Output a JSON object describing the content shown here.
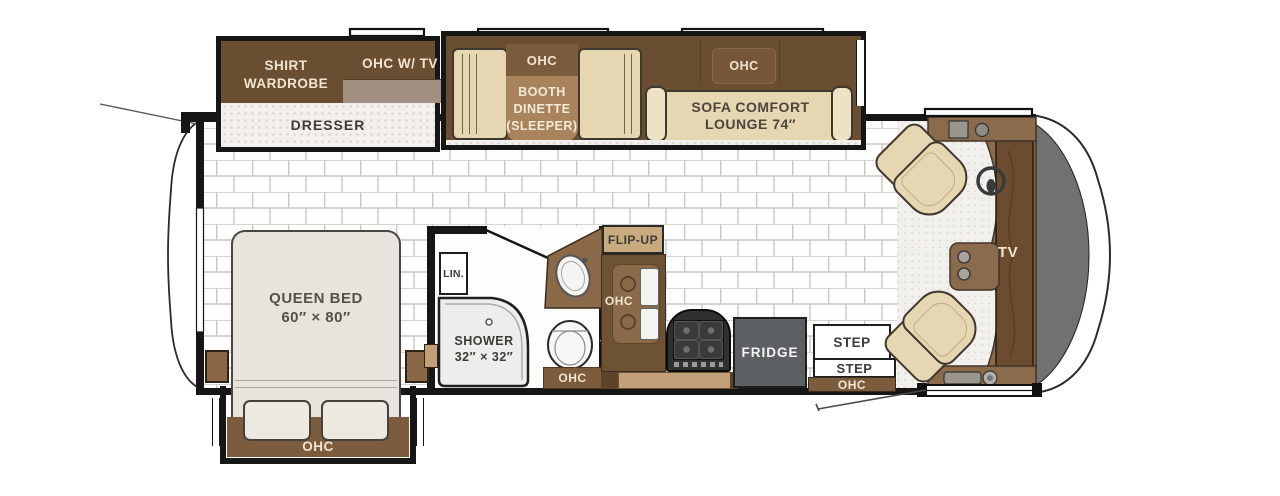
{
  "title": "Motorhome floor plan",
  "colors": {
    "cabinet-dark": "#6a4e31",
    "cabinet-mid": "#8a6a48",
    "cabinet-light": "#a8835c",
    "band-brown": "#7b5d3d",
    "counter-tan": "#c3a178",
    "upholstery-tan": "#e6d6b1",
    "upholstery-light": "#eee2c4",
    "bed-gray": "#e6e4dd",
    "speckle-bg": "#f2f0ec",
    "speckle-dot": "#d8d3cb",
    "wall-black": "#161616",
    "fridge-gray": "#5d6063",
    "windshield-gray": "#6f7173",
    "dash-brown": "#8a6b4b",
    "cream-text": "#f1e5d1",
    "dark-text": "#3e3b36"
  },
  "bedroom": {
    "wardrobe_label": "SHIRT\nWARDROBE",
    "ohc_tv_label": "OHC W/ TV",
    "dresser_label": "DRESSER",
    "bed_label": "QUEEN BED\n60″ × 80″",
    "bed_ohc_label": "OHC"
  },
  "dinette": {
    "ohc_label": "OHC",
    "table_label": "BOOTH\nDINETTE\n(SLEEPER)"
  },
  "sofa": {
    "ohc_label": "OHC",
    "label": "SOFA COMFORT\nLOUNGE 74″"
  },
  "bathroom": {
    "linen_label": "LIN.",
    "shower_label": "SHOWER\n32″ × 32″",
    "ohc_label": "OHC"
  },
  "kitchen": {
    "flip_up_label": "FLIP-UP",
    "ohc_label": "OHC",
    "fridge_label": "FRIDGE"
  },
  "entry": {
    "step_upper_label": "STEP",
    "step_lower_label": "STEP",
    "ohc_label": "OHC"
  },
  "cockpit": {
    "tv_label": "TV"
  }
}
